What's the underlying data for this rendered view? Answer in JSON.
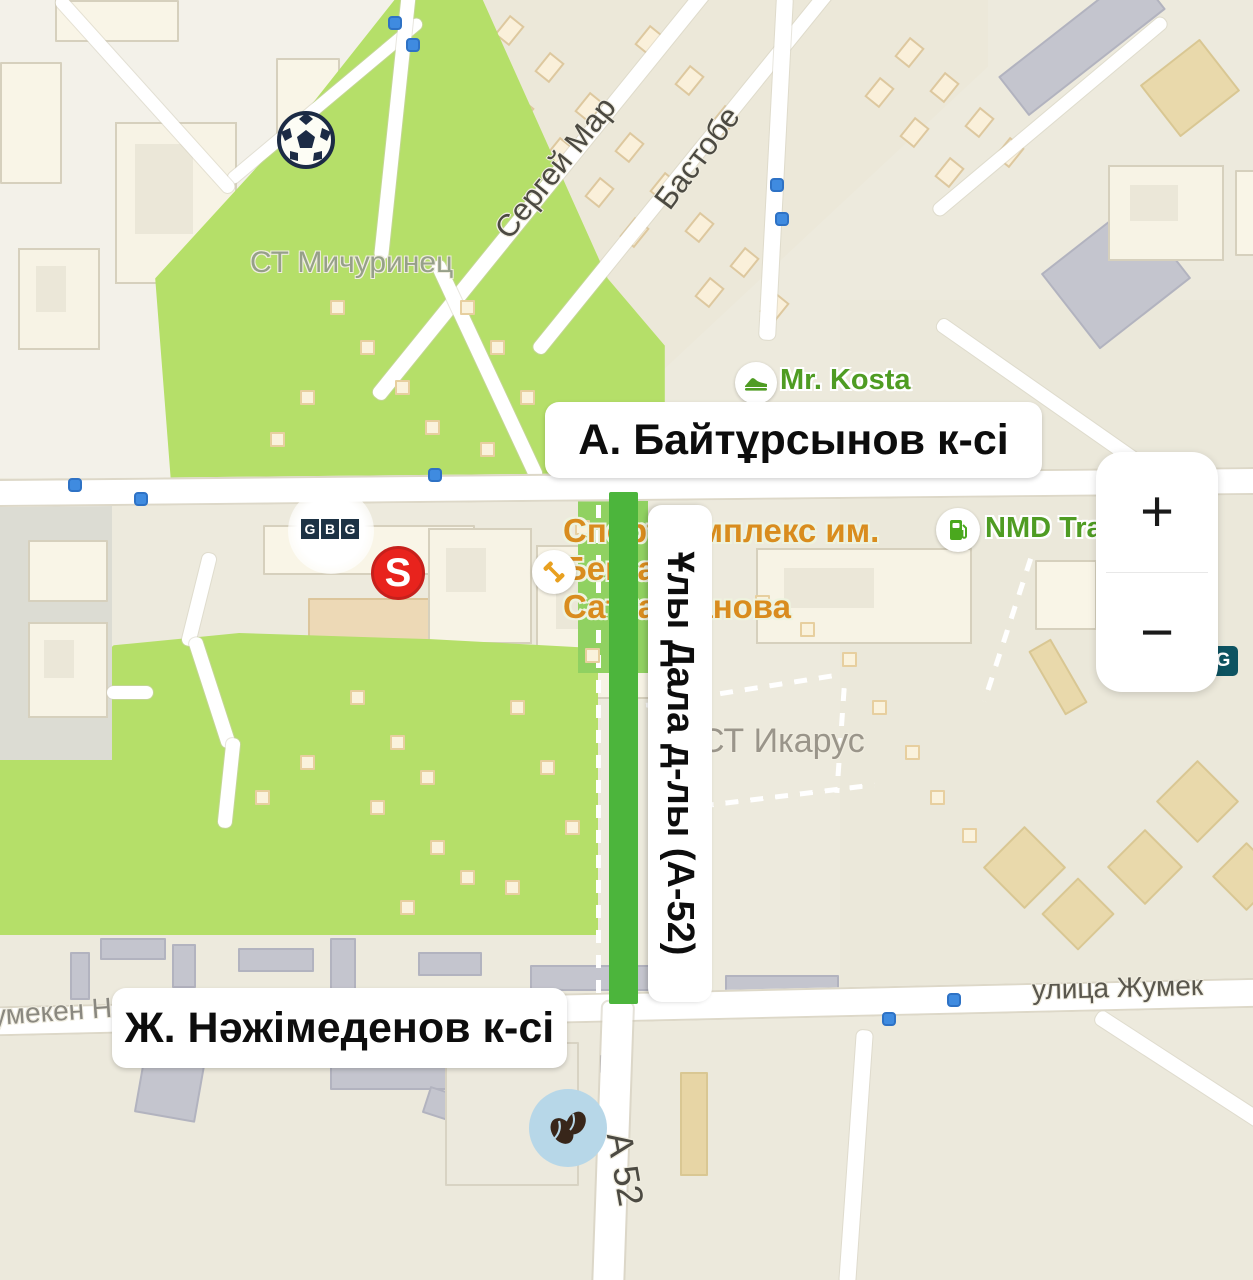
{
  "map": {
    "street_labels": {
      "baitursynov": "А. Байтұрсынов к-сі",
      "nazhimedenov": "Ж. Нәжімеденов к-сі",
      "uly_dala": "Ұлы Дала д-лы (А-52)"
    },
    "street_names": {
      "sergey_mar": "Сергей Мар",
      "bastobe": "Бастобе",
      "st_michurinets": "СТ Мичуринец",
      "st_ikarus": "СТ Икарус",
      "ulitsa_zhumek": "улица Жумек",
      "umeken_fragment": "умекен Н",
      "a52": "А 52"
    },
    "pois": {
      "mr_kosta": {
        "label": "Mr. Kosta",
        "icon": "sneaker-icon"
      },
      "nmd": {
        "label": "NMD Tra",
        "icon": "fuel-pump-icon"
      },
      "sport_complex": {
        "line1": "Спорткомплекс им.",
        "line2": "Бекзата",
        "line3": "Саттарханова",
        "icon": "dumbbell-icon"
      },
      "gbg": {
        "letters": [
          "G",
          "B",
          "G"
        ]
      },
      "s_market": {
        "letter": "S"
      },
      "g_badge": {
        "letter": "G"
      },
      "soccer": {
        "icon": "soccer-ball-icon"
      },
      "coffee": {
        "icon": "coffee-beans-icon"
      }
    },
    "zoom_control": {
      "zoom_in": "+",
      "zoom_out": "−"
    },
    "colors": {
      "park_green": "#b5df69",
      "route_green": "#4cb53c",
      "poi_green": "#4f9c23",
      "poi_orange": "#d98c1e",
      "transit_blue": "#3f8be0",
      "road_white": "#ffffff",
      "label_text": "#0d0d0d"
    }
  }
}
